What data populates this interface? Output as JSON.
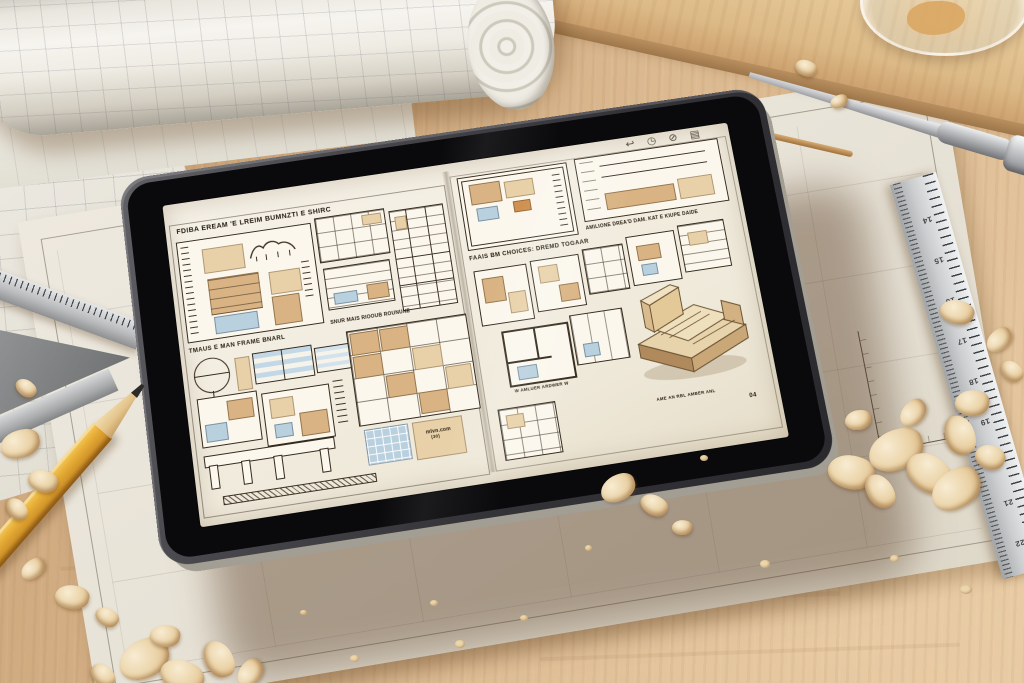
{
  "tablet": {
    "toolbar": {
      "icons": [
        {
          "name": "share",
          "glyph": "↩"
        },
        {
          "name": "clock",
          "glyph": "◷"
        },
        {
          "name": "contrast",
          "glyph": "⊘"
        },
        {
          "name": "library",
          "glyph": "▤"
        }
      ]
    },
    "document": {
      "left_page": {
        "title": "FDIBA EREAM 'E LREIM BUMNZTI E SHIRC",
        "mid_label": "TMAUS E MAN FRAME BNARL",
        "center_label": "SNUR MAIS RIOOUB ROUNUNE",
        "titleblock_line1": "mlvn.com",
        "titleblock_line2": "(30)"
      },
      "right_page": {
        "header": "FAAIS BM CHOICES: DREMD TOGAAR",
        "subheader": "AMILIONE DREA'D DAM. KAT E KIUPE DAIDE",
        "small_caption": "W AMLUER ARDWER W",
        "iso_caption": "AME AN RBL AMBER ANL",
        "page_number": "04"
      }
    }
  },
  "ruler": {
    "numbers": [
      "14",
      "15",
      "16",
      "17",
      "18",
      "19",
      "20",
      "21",
      "22"
    ]
  },
  "colors": {
    "wood_table": "#d8b58c",
    "wood_plank": "#e0c193",
    "paper": "#efece3",
    "screen_paper": "#f3efe5",
    "tablet_frame": "#3c3c40",
    "tablet_bezel": "#0b0b0d",
    "tan_fill": "#d9b383",
    "light_tan": "#e8d1a8",
    "blue_fill": "#b9d0de",
    "ink": "#2e2519",
    "pencil_yellow": "#e2a93b",
    "steel": "#c7c9cb",
    "shaving": "#edd7ae"
  }
}
